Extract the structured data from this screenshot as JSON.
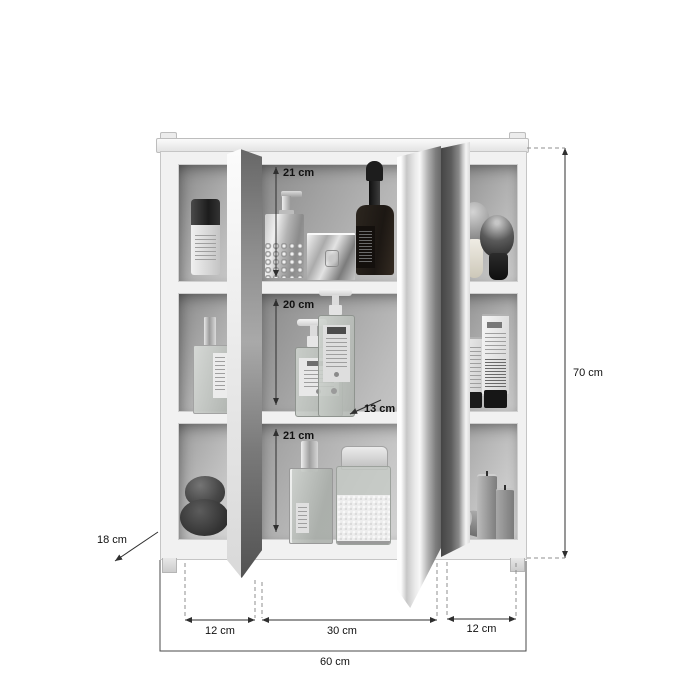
{
  "diagram": {
    "title": "bathroom-mirror-cabinet-dimension-diagram",
    "dimensions": {
      "top_shelf_height": "21 cm",
      "middle_shelf_height": "20 cm",
      "bottom_shelf_height": "21 cm",
      "shelf_depth": "13 cm",
      "total_height": "70 cm",
      "total_depth": "18 cm",
      "left_compartment_width": "12 cm",
      "center_compartment_width": "30 cm",
      "right_compartment_width": "12 cm",
      "total_width": "60 cm"
    },
    "colors": {
      "background": "#ffffff",
      "dimension_line": "#2f2f2f",
      "extension_line": "#8a8a8a",
      "cabinet_frame": "#f1f1f1",
      "cabinet_border": "#c5c5c5",
      "cell_interior_dark": "#8a8a8a",
      "cell_interior_light": "#cdcdcd"
    }
  }
}
